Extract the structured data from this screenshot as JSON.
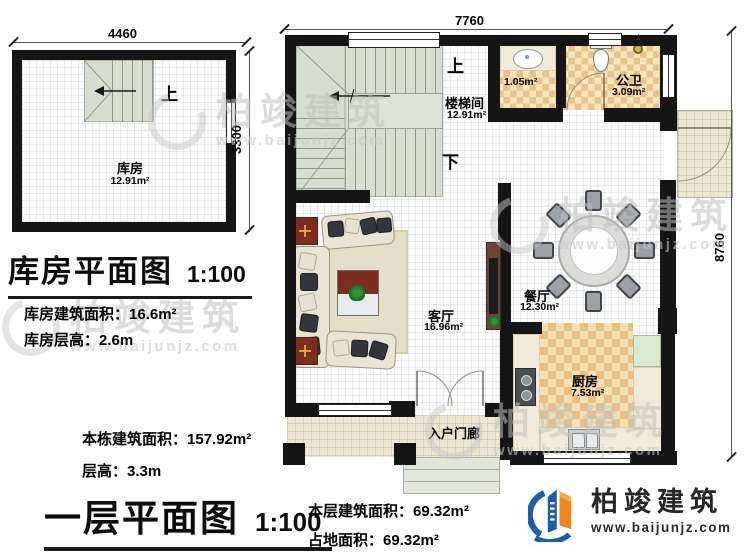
{
  "storage": {
    "dim_width": "4460",
    "dim_height": "3300",
    "up": "上",
    "room": "库房",
    "room_area": "12.91m²",
    "title": "库房平面图",
    "scale": "1:100",
    "stats": [
      {
        "label": "库房建筑面积：",
        "value": "16.6m²"
      },
      {
        "label": "库房层高：",
        "value": "2.6m"
      }
    ]
  },
  "floor": {
    "dim_width": "7760",
    "dim_height": "8760",
    "up": "上",
    "down": "下",
    "stairwell": "楼梯间",
    "stairwell_area": "12.91m²",
    "washroom_area": "1.05m²",
    "toilet": "公卫",
    "toilet_area": "3.09m²",
    "living": "客厅",
    "living_area": "16.96m²",
    "dining": "餐厅",
    "dining_area": "12.30m²",
    "kitchen": "厨房",
    "kitchen_area": "7.53m²",
    "porch": "入户门廊",
    "title": "一层平面图",
    "scale": "1:100",
    "stats_left": [
      {
        "label": "本栋建筑面积：",
        "value": "157.92m²"
      },
      {
        "label": "层高：",
        "value": "3.3m"
      }
    ],
    "stats_bottom": [
      {
        "label": "本层建筑面积：",
        "value": "69.32m²"
      },
      {
        "label": "占地面积：",
        "value": "69.32m²"
      }
    ]
  },
  "watermark": {
    "brand": "柏竣建筑",
    "url": "www.baijunjz.com"
  },
  "logo": {
    "brand": "柏竣建筑",
    "url": "www.baijunjz.com"
  }
}
